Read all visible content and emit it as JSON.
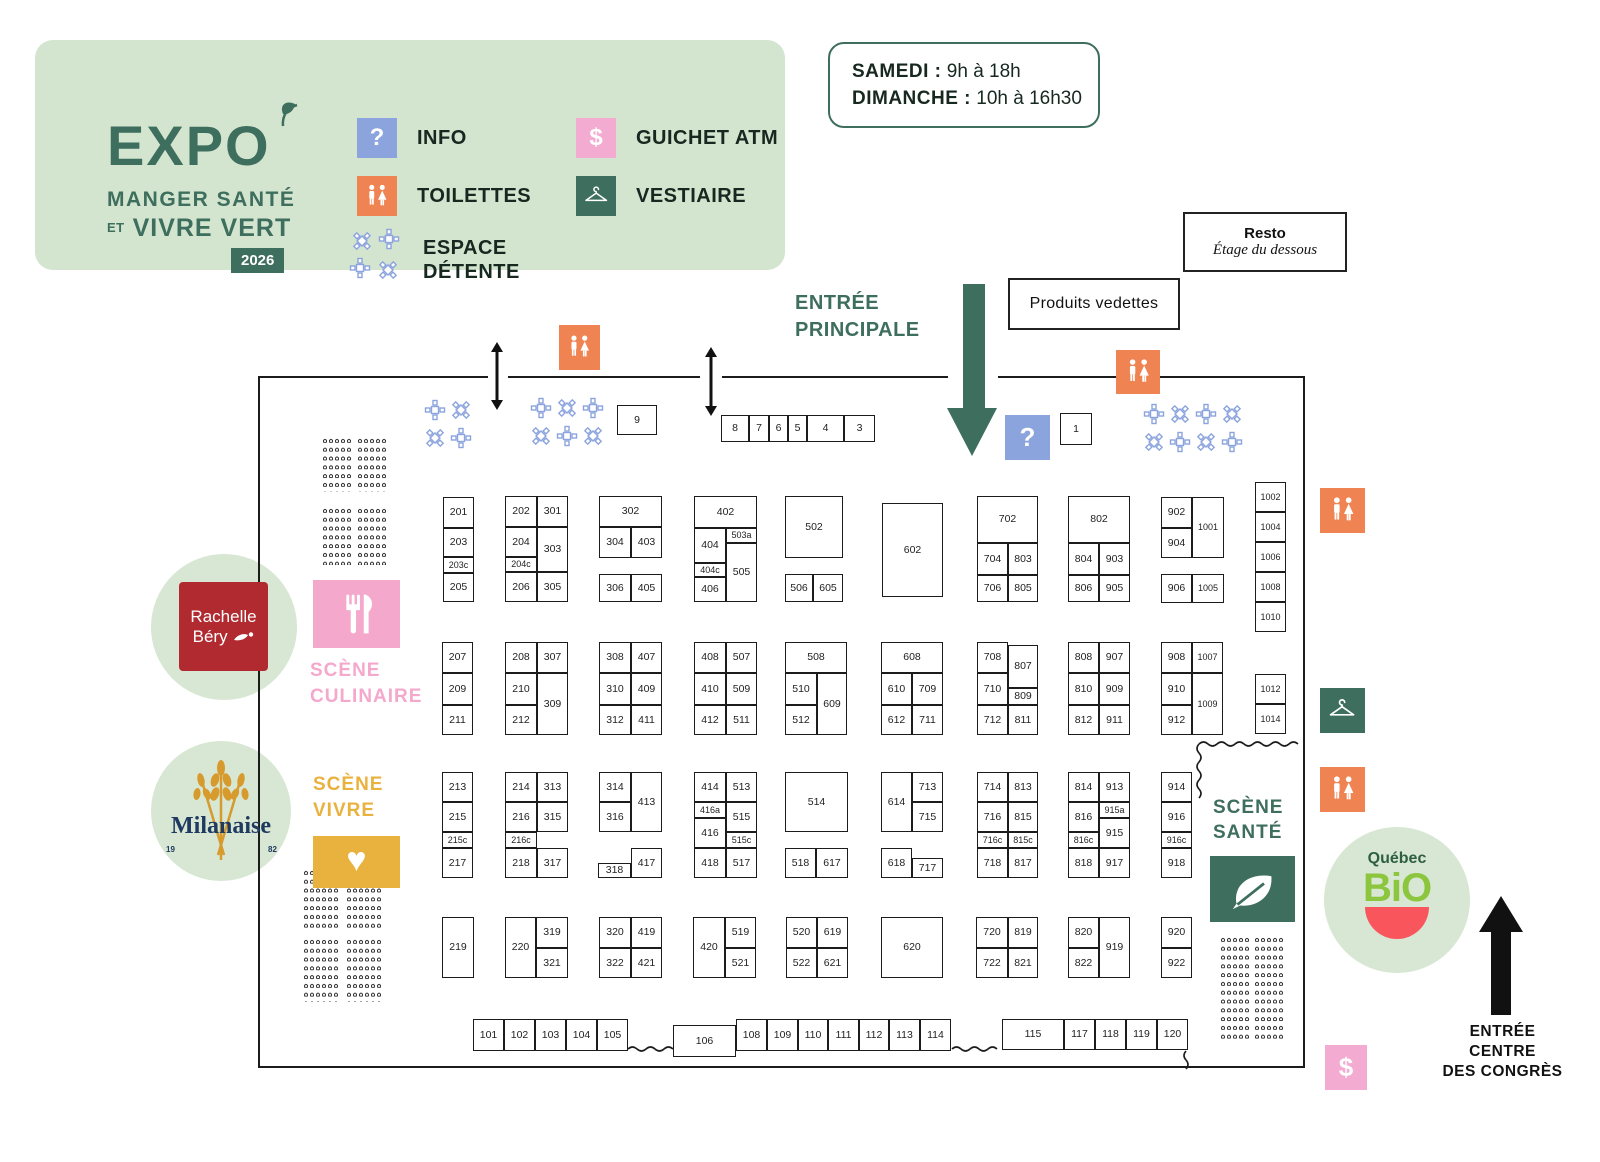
{
  "legend": {
    "logo": {
      "title": "EXPO",
      "line2": "MANGER SANTÉ",
      "line3_small": "ET",
      "line3": "VIVRE VERT",
      "badge": "2026"
    },
    "items": [
      {
        "icon": "info-icon",
        "type": "info",
        "label": "INFO",
        "x": 322,
        "y": 78
      },
      {
        "icon": "toilets-icon",
        "type": "toilets",
        "label": "TOILETTES",
        "x": 322,
        "y": 136
      },
      {
        "icon": "detente-icon",
        "type": "detente",
        "label": "ESPACE\nDÉTENTE",
        "x": 316,
        "y": 188
      },
      {
        "icon": "atm-icon",
        "type": "atm",
        "label": "GUICHET ATM",
        "x": 541,
        "y": 78
      },
      {
        "icon": "vestiaire-icon",
        "type": "vestiaire",
        "label": "VESTIAIRE",
        "x": 541,
        "y": 136
      }
    ]
  },
  "hours": {
    "line1_label": "SAMEDI :",
    "line1_value": " 9h à 18h",
    "line2_label": "DIMANCHE :",
    "line2_value": " 10h à 16h30"
  },
  "labels": {
    "resto_title": "Resto",
    "resto_sub": "Étage du dessous",
    "produits": "Produits vedettes",
    "entree_principale": "ENTRÉE\nPRINCIPALE",
    "entree_congres": "ENTRÉE\nCENTRE\nDES CONGRÈS",
    "scene_culinaire": "SCÈNE\nCULINAIRE",
    "scene_vivre": "SCÈNE\nVIVRE",
    "scene_sante": "SCÈNE\nSANTÉ"
  },
  "sponsors": {
    "rachelle_line1": "Rachelle",
    "rachelle_line2": "Béry",
    "milanaise": "Milanaise",
    "milanaise_yr1": "19",
    "milanaise_yr2": "82",
    "bio_top": "Québec",
    "bio_main": "BiO"
  },
  "colors": {
    "panel_bg": "#d3e4cf",
    "dark_green": "#3e6e5d",
    "orange": "#ef8352",
    "blue": "#8ca4de",
    "pink_atm": "#f3abd2",
    "pink_scene": "#f4a9cc",
    "yellow": "#e9b23e",
    "circle_green": "#d7e7d3",
    "rachelle_red": "#b02a30",
    "bio_green": "#8cc63e",
    "bio_red": "#f8555c",
    "milanaise_navy": "#1f3a60",
    "flower_blue": "#8ca4de",
    "booth_border": "#1c1c1c"
  },
  "booths": [
    [
      "9",
      617,
      405,
      40,
      30
    ],
    [
      "8",
      721,
      415,
      28,
      27
    ],
    [
      "7",
      749,
      415,
      20,
      27
    ],
    [
      "6",
      769,
      415,
      19,
      27
    ],
    [
      "5",
      788,
      415,
      19,
      27
    ],
    [
      "4",
      807,
      415,
      37,
      27
    ],
    [
      "3",
      844,
      415,
      31,
      27
    ],
    [
      "1",
      1060,
      413,
      32,
      32
    ],
    [
      "201",
      443,
      497,
      31,
      31
    ],
    [
      "203",
      443,
      528,
      31,
      29
    ],
    [
      "203c",
      443,
      557,
      31,
      16
    ],
    [
      "205",
      443,
      573,
      31,
      29
    ],
    [
      "202",
      505,
      496,
      32,
      31
    ],
    [
      "301",
      537,
      496,
      31,
      31
    ],
    [
      "204",
      505,
      527,
      32,
      30
    ],
    [
      "303",
      537,
      527,
      31,
      45
    ],
    [
      "204c",
      505,
      557,
      32,
      15
    ],
    [
      "206",
      505,
      572,
      32,
      30
    ],
    [
      "305",
      537,
      572,
      31,
      30
    ],
    [
      "302",
      599,
      496,
      63,
      31
    ],
    [
      "304",
      599,
      527,
      32,
      31
    ],
    [
      "403",
      631,
      527,
      31,
      31
    ],
    [
      "306",
      599,
      574,
      32,
      28
    ],
    [
      "405",
      631,
      574,
      31,
      28
    ],
    [
      "402",
      694,
      496,
      63,
      32
    ],
    [
      "404",
      694,
      528,
      32,
      35
    ],
    [
      "503a",
      726,
      528,
      31,
      15
    ],
    [
      "505",
      726,
      543,
      31,
      59
    ],
    [
      "404c",
      694,
      563,
      32,
      14
    ],
    [
      "406",
      694,
      577,
      32,
      25
    ],
    [
      "502",
      785,
      496,
      58,
      62
    ],
    [
      "506",
      785,
      574,
      28,
      28
    ],
    [
      "605",
      813,
      574,
      30,
      28
    ],
    [
      "602",
      882,
      503,
      61,
      94
    ],
    [
      "702",
      977,
      496,
      61,
      47
    ],
    [
      "704",
      977,
      543,
      31,
      32
    ],
    [
      "803",
      1008,
      543,
      30,
      32
    ],
    [
      "706",
      977,
      575,
      31,
      27
    ],
    [
      "805",
      1008,
      575,
      30,
      27
    ],
    [
      "802",
      1068,
      496,
      62,
      47
    ],
    [
      "804",
      1068,
      543,
      31,
      32
    ],
    [
      "903",
      1099,
      543,
      31,
      32
    ],
    [
      "806",
      1068,
      575,
      31,
      27
    ],
    [
      "905",
      1099,
      575,
      31,
      27
    ],
    [
      "902",
      1161,
      497,
      31,
      31
    ],
    [
      "904",
      1161,
      528,
      31,
      30
    ],
    [
      "1001",
      1192,
      497,
      32,
      61
    ],
    [
      "906",
      1161,
      574,
      31,
      29
    ],
    [
      "1005",
      1192,
      574,
      32,
      29
    ],
    [
      "1002",
      1255,
      482,
      31,
      30
    ],
    [
      "1004",
      1255,
      512,
      31,
      30
    ],
    [
      "1006",
      1255,
      542,
      31,
      30
    ],
    [
      "1008",
      1255,
      572,
      31,
      30
    ],
    [
      "1010",
      1255,
      602,
      31,
      30
    ],
    [
      "207",
      442,
      642,
      31,
      31
    ],
    [
      "209",
      442,
      673,
      31,
      32
    ],
    [
      "211",
      442,
      705,
      31,
      30
    ],
    [
      "208",
      505,
      642,
      32,
      31
    ],
    [
      "307",
      537,
      642,
      31,
      31
    ],
    [
      "210",
      505,
      673,
      32,
      32
    ],
    [
      "309",
      537,
      673,
      31,
      62
    ],
    [
      "212",
      505,
      705,
      32,
      30
    ],
    [
      "308",
      599,
      642,
      32,
      31
    ],
    [
      "407",
      631,
      642,
      31,
      31
    ],
    [
      "310",
      599,
      673,
      32,
      32
    ],
    [
      "409",
      631,
      673,
      31,
      32
    ],
    [
      "312",
      599,
      705,
      32,
      30
    ],
    [
      "411",
      631,
      705,
      31,
      30
    ],
    [
      "408",
      694,
      642,
      32,
      31
    ],
    [
      "507",
      726,
      642,
      31,
      31
    ],
    [
      "410",
      694,
      673,
      32,
      32
    ],
    [
      "509",
      726,
      673,
      31,
      32
    ],
    [
      "412",
      694,
      705,
      32,
      30
    ],
    [
      "511",
      726,
      705,
      31,
      30
    ],
    [
      "508",
      785,
      642,
      62,
      31
    ],
    [
      "510",
      785,
      673,
      32,
      32
    ],
    [
      "609",
      817,
      673,
      30,
      62
    ],
    [
      "512",
      785,
      705,
      32,
      30
    ],
    [
      "608",
      881,
      642,
      62,
      31
    ],
    [
      "610",
      881,
      673,
      31,
      32
    ],
    [
      "709",
      912,
      673,
      31,
      32
    ],
    [
      "612",
      881,
      705,
      31,
      30
    ],
    [
      "711",
      912,
      705,
      31,
      30
    ],
    [
      "708",
      977,
      642,
      31,
      31
    ],
    [
      "807",
      1008,
      645,
      30,
      43
    ],
    [
      "710",
      977,
      673,
      31,
      32
    ],
    [
      "809",
      1008,
      688,
      30,
      17
    ],
    [
      "712",
      977,
      705,
      31,
      30
    ],
    [
      "811",
      1008,
      705,
      30,
      30
    ],
    [
      "808",
      1068,
      642,
      31,
      31
    ],
    [
      "907",
      1099,
      642,
      31,
      31
    ],
    [
      "810",
      1068,
      673,
      31,
      32
    ],
    [
      "909",
      1099,
      673,
      31,
      32
    ],
    [
      "812",
      1068,
      705,
      31,
      30
    ],
    [
      "911",
      1099,
      705,
      31,
      30
    ],
    [
      "908",
      1161,
      642,
      31,
      31
    ],
    [
      "1007",
      1192,
      642,
      31,
      31
    ],
    [
      "910",
      1161,
      673,
      31,
      32
    ],
    [
      "1009",
      1192,
      673,
      31,
      62
    ],
    [
      "912",
      1161,
      705,
      31,
      30
    ],
    [
      "1012",
      1255,
      674,
      31,
      30
    ],
    [
      "1014",
      1255,
      704,
      31,
      30
    ],
    [
      "213",
      442,
      772,
      31,
      30
    ],
    [
      "215",
      442,
      802,
      31,
      30
    ],
    [
      "215c",
      442,
      832,
      31,
      16
    ],
    [
      "217",
      442,
      848,
      31,
      30
    ],
    [
      "214",
      505,
      772,
      32,
      30
    ],
    [
      "313",
      537,
      772,
      31,
      30
    ],
    [
      "216",
      505,
      802,
      32,
      30
    ],
    [
      "315",
      537,
      802,
      31,
      30
    ],
    [
      "216c",
      505,
      832,
      32,
      16
    ],
    [
      "218",
      505,
      848,
      32,
      30
    ],
    [
      "317",
      537,
      848,
      31,
      30
    ],
    [
      "314",
      599,
      772,
      32,
      30
    ],
    [
      "413",
      631,
      772,
      31,
      60
    ],
    [
      "316",
      599,
      802,
      32,
      30
    ],
    [
      "318",
      598,
      863,
      33,
      15
    ],
    [
      "417",
      631,
      848,
      31,
      30
    ],
    [
      "414",
      694,
      772,
      32,
      30
    ],
    [
      "513",
      726,
      772,
      31,
      30
    ],
    [
      "416a",
      694,
      802,
      32,
      16
    ],
    [
      "515",
      726,
      802,
      31,
      30
    ],
    [
      "416",
      694,
      818,
      32,
      30
    ],
    [
      "515c",
      726,
      832,
      31,
      16
    ],
    [
      "418",
      694,
      848,
      32,
      30
    ],
    [
      "517",
      726,
      848,
      31,
      30
    ],
    [
      "514",
      785,
      772,
      63,
      60
    ],
    [
      "518",
      785,
      848,
      31,
      30
    ],
    [
      "617",
      816,
      848,
      32,
      30
    ],
    [
      "614",
      881,
      772,
      31,
      60
    ],
    [
      "713",
      912,
      772,
      31,
      30
    ],
    [
      "715",
      912,
      802,
      31,
      30
    ],
    [
      "618",
      881,
      848,
      31,
      30
    ],
    [
      "717",
      912,
      858,
      31,
      20
    ],
    [
      "714",
      977,
      772,
      31,
      30
    ],
    [
      "813",
      1008,
      772,
      30,
      30
    ],
    [
      "716",
      977,
      802,
      31,
      30
    ],
    [
      "815",
      1008,
      802,
      30,
      30
    ],
    [
      "716c",
      977,
      832,
      31,
      16
    ],
    [
      "815c",
      1008,
      832,
      30,
      16
    ],
    [
      "718",
      977,
      848,
      31,
      30
    ],
    [
      "817",
      1008,
      848,
      30,
      30
    ],
    [
      "814",
      1068,
      772,
      31,
      30
    ],
    [
      "913",
      1099,
      772,
      31,
      30
    ],
    [
      "816",
      1068,
      802,
      31,
      30
    ],
    [
      "915a",
      1099,
      802,
      31,
      16
    ],
    [
      "915",
      1099,
      818,
      31,
      30
    ],
    [
      "816c",
      1068,
      832,
      31,
      16
    ],
    [
      "818",
      1068,
      848,
      31,
      30
    ],
    [
      "917",
      1099,
      848,
      31,
      30
    ],
    [
      "914",
      1161,
      772,
      31,
      30
    ],
    [
      "916",
      1161,
      802,
      31,
      30
    ],
    [
      "916c",
      1161,
      832,
      31,
      16
    ],
    [
      "918",
      1161,
      848,
      31,
      30
    ],
    [
      "219",
      442,
      917,
      32,
      61
    ],
    [
      "220",
      505,
      917,
      31,
      61
    ],
    [
      "319",
      536,
      917,
      32,
      31
    ],
    [
      "321",
      536,
      948,
      32,
      30
    ],
    [
      "320",
      599,
      917,
      32,
      31
    ],
    [
      "419",
      631,
      917,
      31,
      31
    ],
    [
      "322",
      599,
      948,
      32,
      30
    ],
    [
      "421",
      631,
      948,
      31,
      30
    ],
    [
      "420",
      693,
      917,
      32,
      61
    ],
    [
      "519",
      725,
      917,
      31,
      31
    ],
    [
      "521",
      725,
      948,
      31,
      30
    ],
    [
      "520",
      786,
      917,
      31,
      31
    ],
    [
      "619",
      817,
      917,
      31,
      31
    ],
    [
      "522",
      786,
      948,
      31,
      30
    ],
    [
      "621",
      817,
      948,
      31,
      30
    ],
    [
      "620",
      881,
      917,
      62,
      61
    ],
    [
      "720",
      976,
      917,
      32,
      31
    ],
    [
      "819",
      1008,
      917,
      30,
      31
    ],
    [
      "722",
      976,
      948,
      32,
      30
    ],
    [
      "821",
      1008,
      948,
      30,
      30
    ],
    [
      "820",
      1068,
      917,
      31,
      31
    ],
    [
      "919",
      1099,
      917,
      31,
      61
    ],
    [
      "822",
      1068,
      948,
      31,
      30
    ],
    [
      "920",
      1161,
      917,
      31,
      31
    ],
    [
      "922",
      1161,
      948,
      31,
      30
    ],
    [
      "101",
      473,
      1019,
      31,
      32
    ],
    [
      "102",
      504,
      1019,
      31,
      32
    ],
    [
      "103",
      535,
      1019,
      31,
      32
    ],
    [
      "104",
      566,
      1019,
      31,
      32
    ],
    [
      "105",
      597,
      1019,
      31,
      32
    ],
    [
      "106",
      673,
      1025,
      63,
      32
    ],
    [
      "108",
      736,
      1019,
      31,
      32
    ],
    [
      "109",
      767,
      1019,
      31,
      32
    ],
    [
      "110",
      798,
      1019,
      30,
      32
    ],
    [
      "111",
      828,
      1019,
      31,
      32
    ],
    [
      "112",
      859,
      1019,
      30,
      32
    ],
    [
      "113",
      889,
      1019,
      31,
      32
    ],
    [
      "114",
      920,
      1019,
      31,
      32
    ],
    [
      "115",
      1002,
      1019,
      62,
      31
    ],
    [
      "117",
      1064,
      1019,
      31,
      31
    ],
    [
      "118",
      1095,
      1019,
      31,
      31
    ],
    [
      "119",
      1126,
      1019,
      31,
      31
    ],
    [
      "120",
      1157,
      1019,
      31,
      31
    ]
  ],
  "map_icons": [
    {
      "type": "toilets",
      "name": "toilets-icon",
      "x": 559,
      "y": 325,
      "w": 41,
      "h": 45
    },
    {
      "type": "toilets",
      "name": "toilets-icon",
      "x": 1116,
      "y": 350,
      "w": 44,
      "h": 44
    },
    {
      "type": "toilets",
      "name": "toilets-icon",
      "x": 1320,
      "y": 488,
      "w": 45,
      "h": 45
    },
    {
      "type": "vestiaire",
      "name": "vestiaire-icon",
      "x": 1320,
      "y": 688,
      "w": 45,
      "h": 45
    },
    {
      "type": "toilets",
      "name": "toilets-icon",
      "x": 1320,
      "y": 767,
      "w": 45,
      "h": 45
    },
    {
      "type": "info",
      "name": "info-icon",
      "x": 1005,
      "y": 415,
      "w": 45,
      "h": 45
    },
    {
      "type": "atm",
      "name": "atm-icon",
      "x": 1325,
      "y": 1045,
      "w": 42,
      "h": 45
    }
  ],
  "detente_clusters": [
    {
      "x": 424,
      "y": 399,
      "cols": 2,
      "rows": 2
    },
    {
      "x": 530,
      "y": 397,
      "cols": 3,
      "rows": 2
    },
    {
      "x": 1143,
      "y": 403,
      "cols": 4,
      "rows": 2
    }
  ],
  "seating_blocks": [
    [
      322,
      437,
      31,
      55
    ],
    [
      357,
      437,
      31,
      55
    ],
    [
      322,
      507,
      31,
      58
    ],
    [
      357,
      507,
      31,
      58
    ],
    [
      303,
      869,
      37,
      62
    ],
    [
      346,
      869,
      37,
      62
    ],
    [
      303,
      938,
      37,
      64
    ],
    [
      346,
      938,
      37,
      64
    ],
    [
      1220,
      936,
      29,
      104
    ],
    [
      1254,
      936,
      29,
      104
    ]
  ]
}
